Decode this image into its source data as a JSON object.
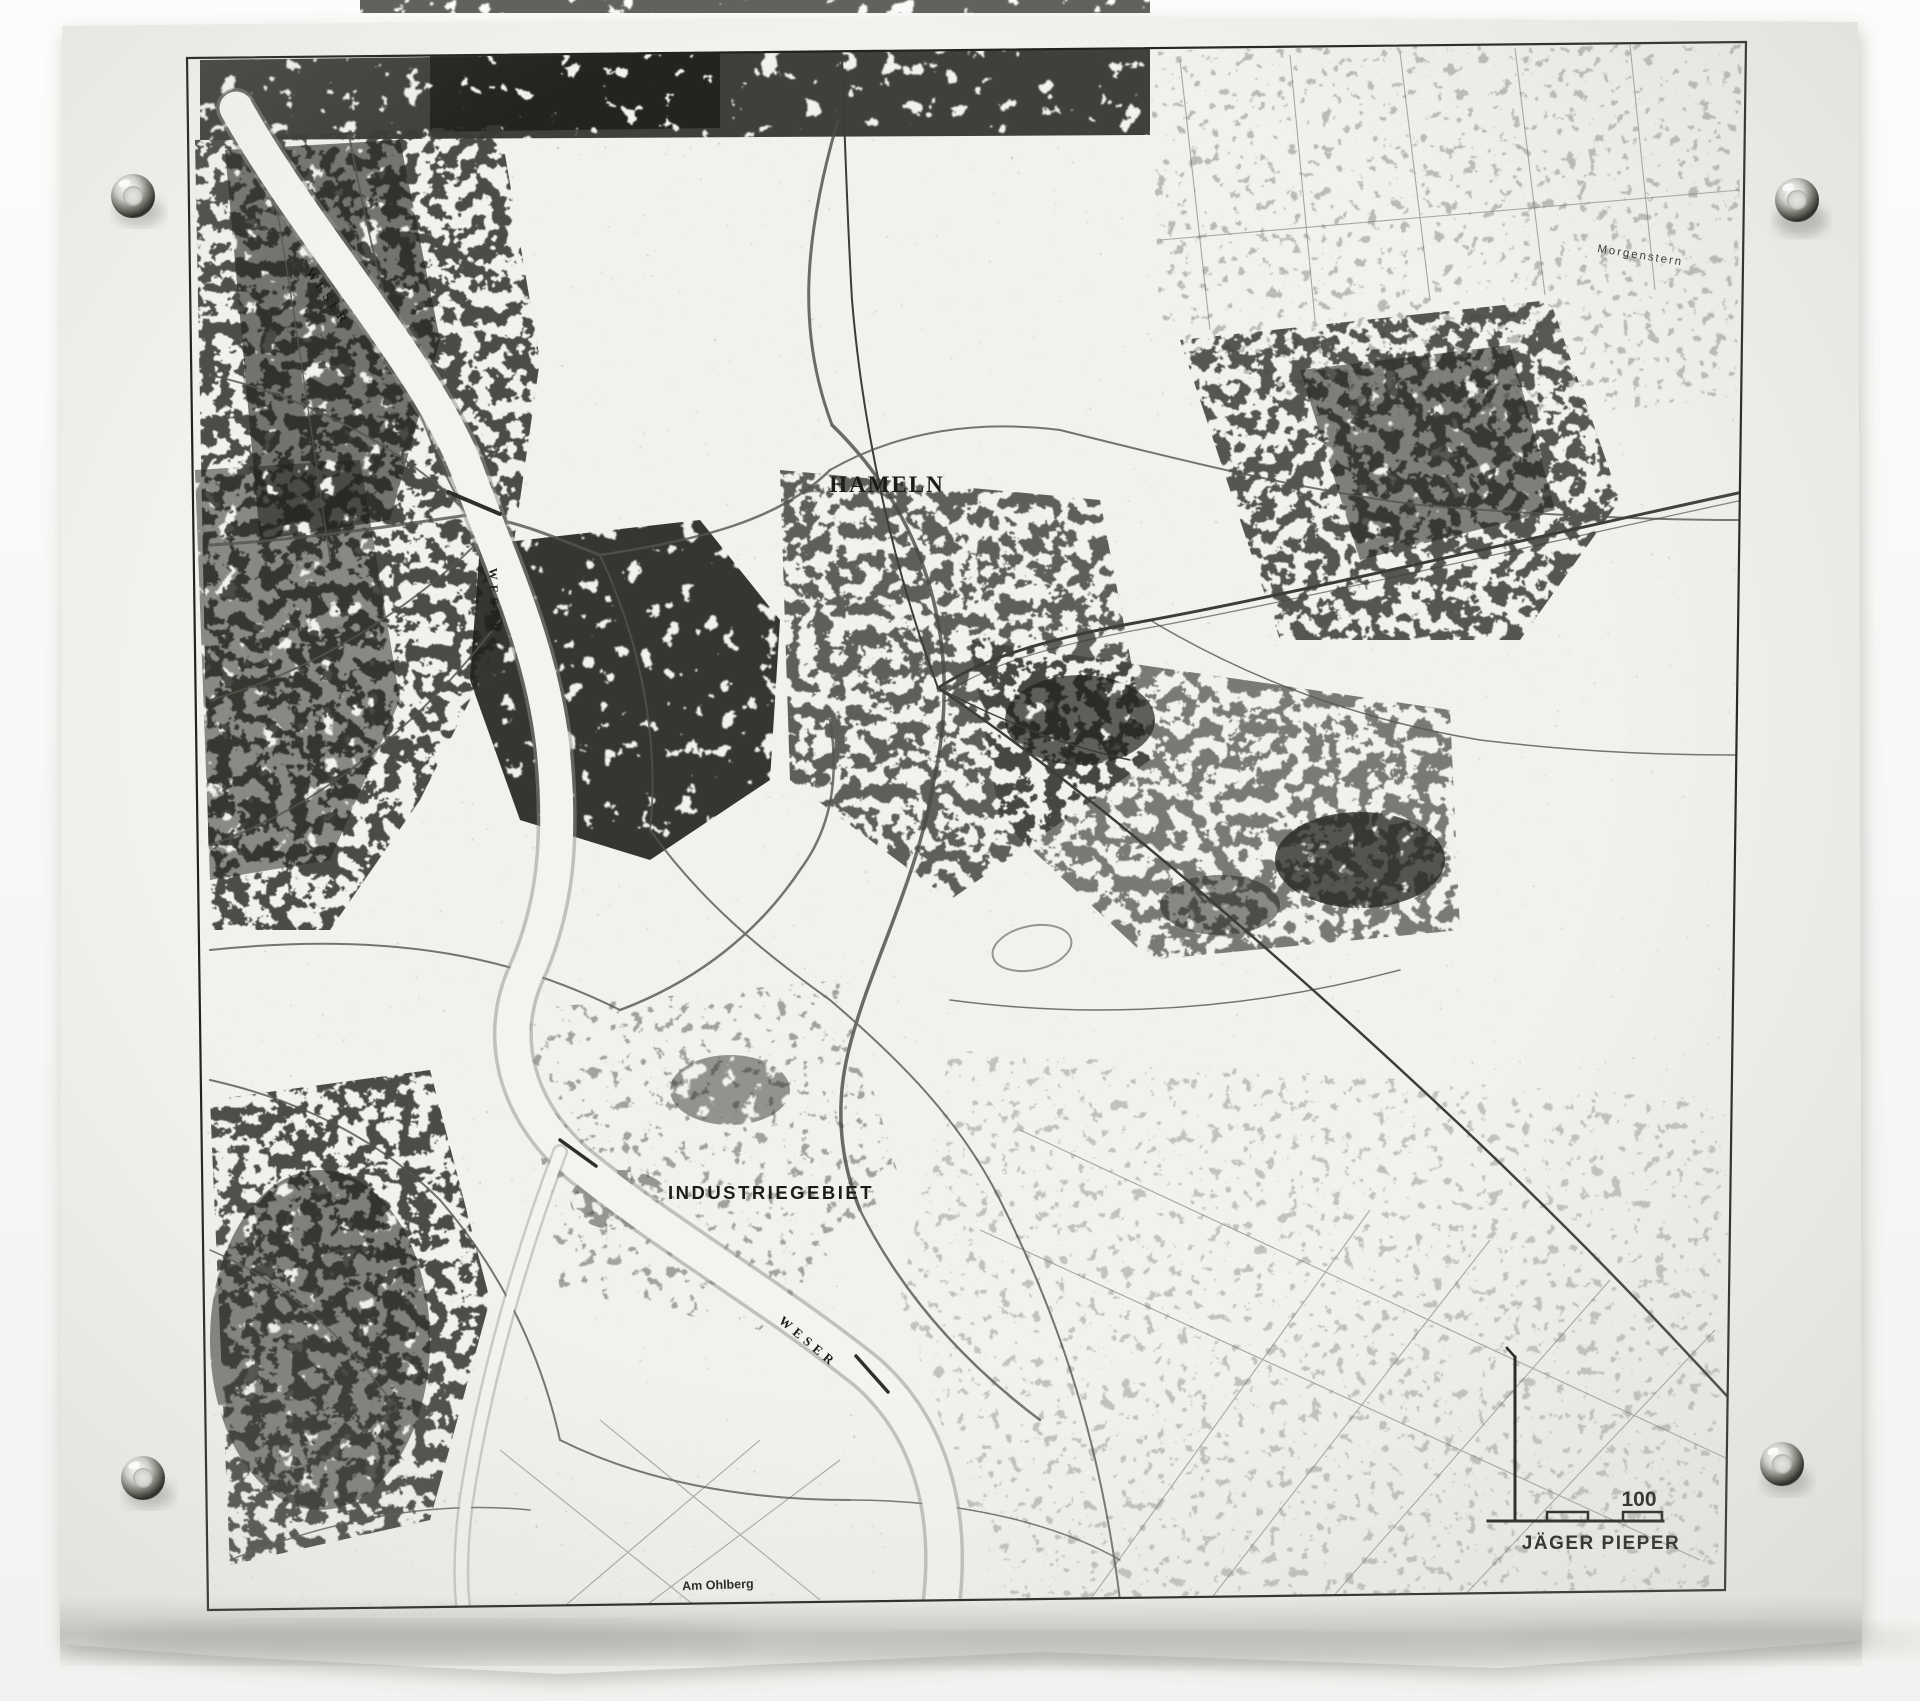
{
  "map": {
    "city_label": "HAMELN",
    "industrial_area_label": "INDUSTRIEGEBIET",
    "river_label": "WESER",
    "river_label_instances": 3,
    "locality_label": "Morgenstern",
    "street_label": "Am Ohlberg",
    "scale_bar_value": "100",
    "artist_signature": "JÄGER PIEPER"
  },
  "colors": {
    "wall": "#f9f9f7",
    "sheet": "#f1f1ee",
    "ink": "#1c1c1a",
    "river": "#f3f3f0",
    "river-bank": "#8f8f89",
    "grommet-metal": "#4a4a47"
  }
}
